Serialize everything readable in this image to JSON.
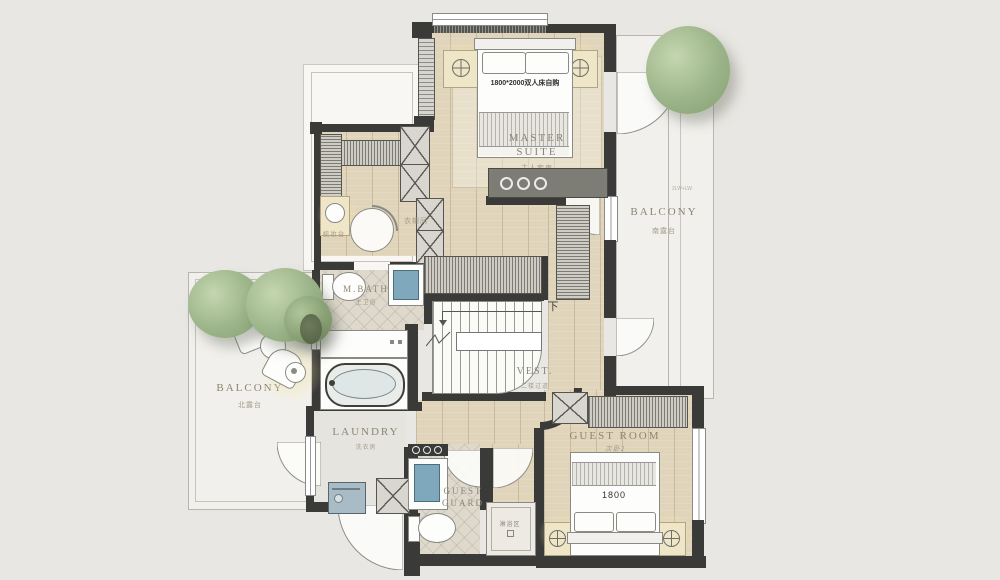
{
  "rooms": {
    "master_suite": {
      "name": "MASTER SUITE",
      "cn": "主人套房"
    },
    "balcony_south": {
      "name": "BALCONY",
      "cn": "南露台",
      "note": "2LW+LW"
    },
    "balcony_north": {
      "name": "BALCONY",
      "cn": "北露台"
    },
    "closet": {
      "cn": "衣帽间"
    },
    "m_bath": {
      "name": "M.BATH",
      "cn": "主卫浴"
    },
    "vest": {
      "name": "VEST.",
      "cn": "二楼过道"
    },
    "laundry": {
      "name": "LAUNDRY",
      "cn": "洗衣房"
    },
    "guest_room": {
      "name": "GUEST ROOM",
      "cn": "次卧2"
    },
    "guest_guard": {
      "line1": "GUEST",
      "line2": "GUARD"
    },
    "shower": {
      "cn": "淋浴区"
    },
    "dressing_table": {
      "cn": "梳妆台"
    }
  },
  "furniture": {
    "master_bed_label": "1800*2000双人床自购",
    "guest_bed_label": "1800",
    "stairs_down": "下"
  },
  "colors": {
    "wall": "#3a3a38",
    "wood": "#e0d4ba",
    "accent_blue": "#7fa8bc",
    "tree": "#9cb489"
  }
}
